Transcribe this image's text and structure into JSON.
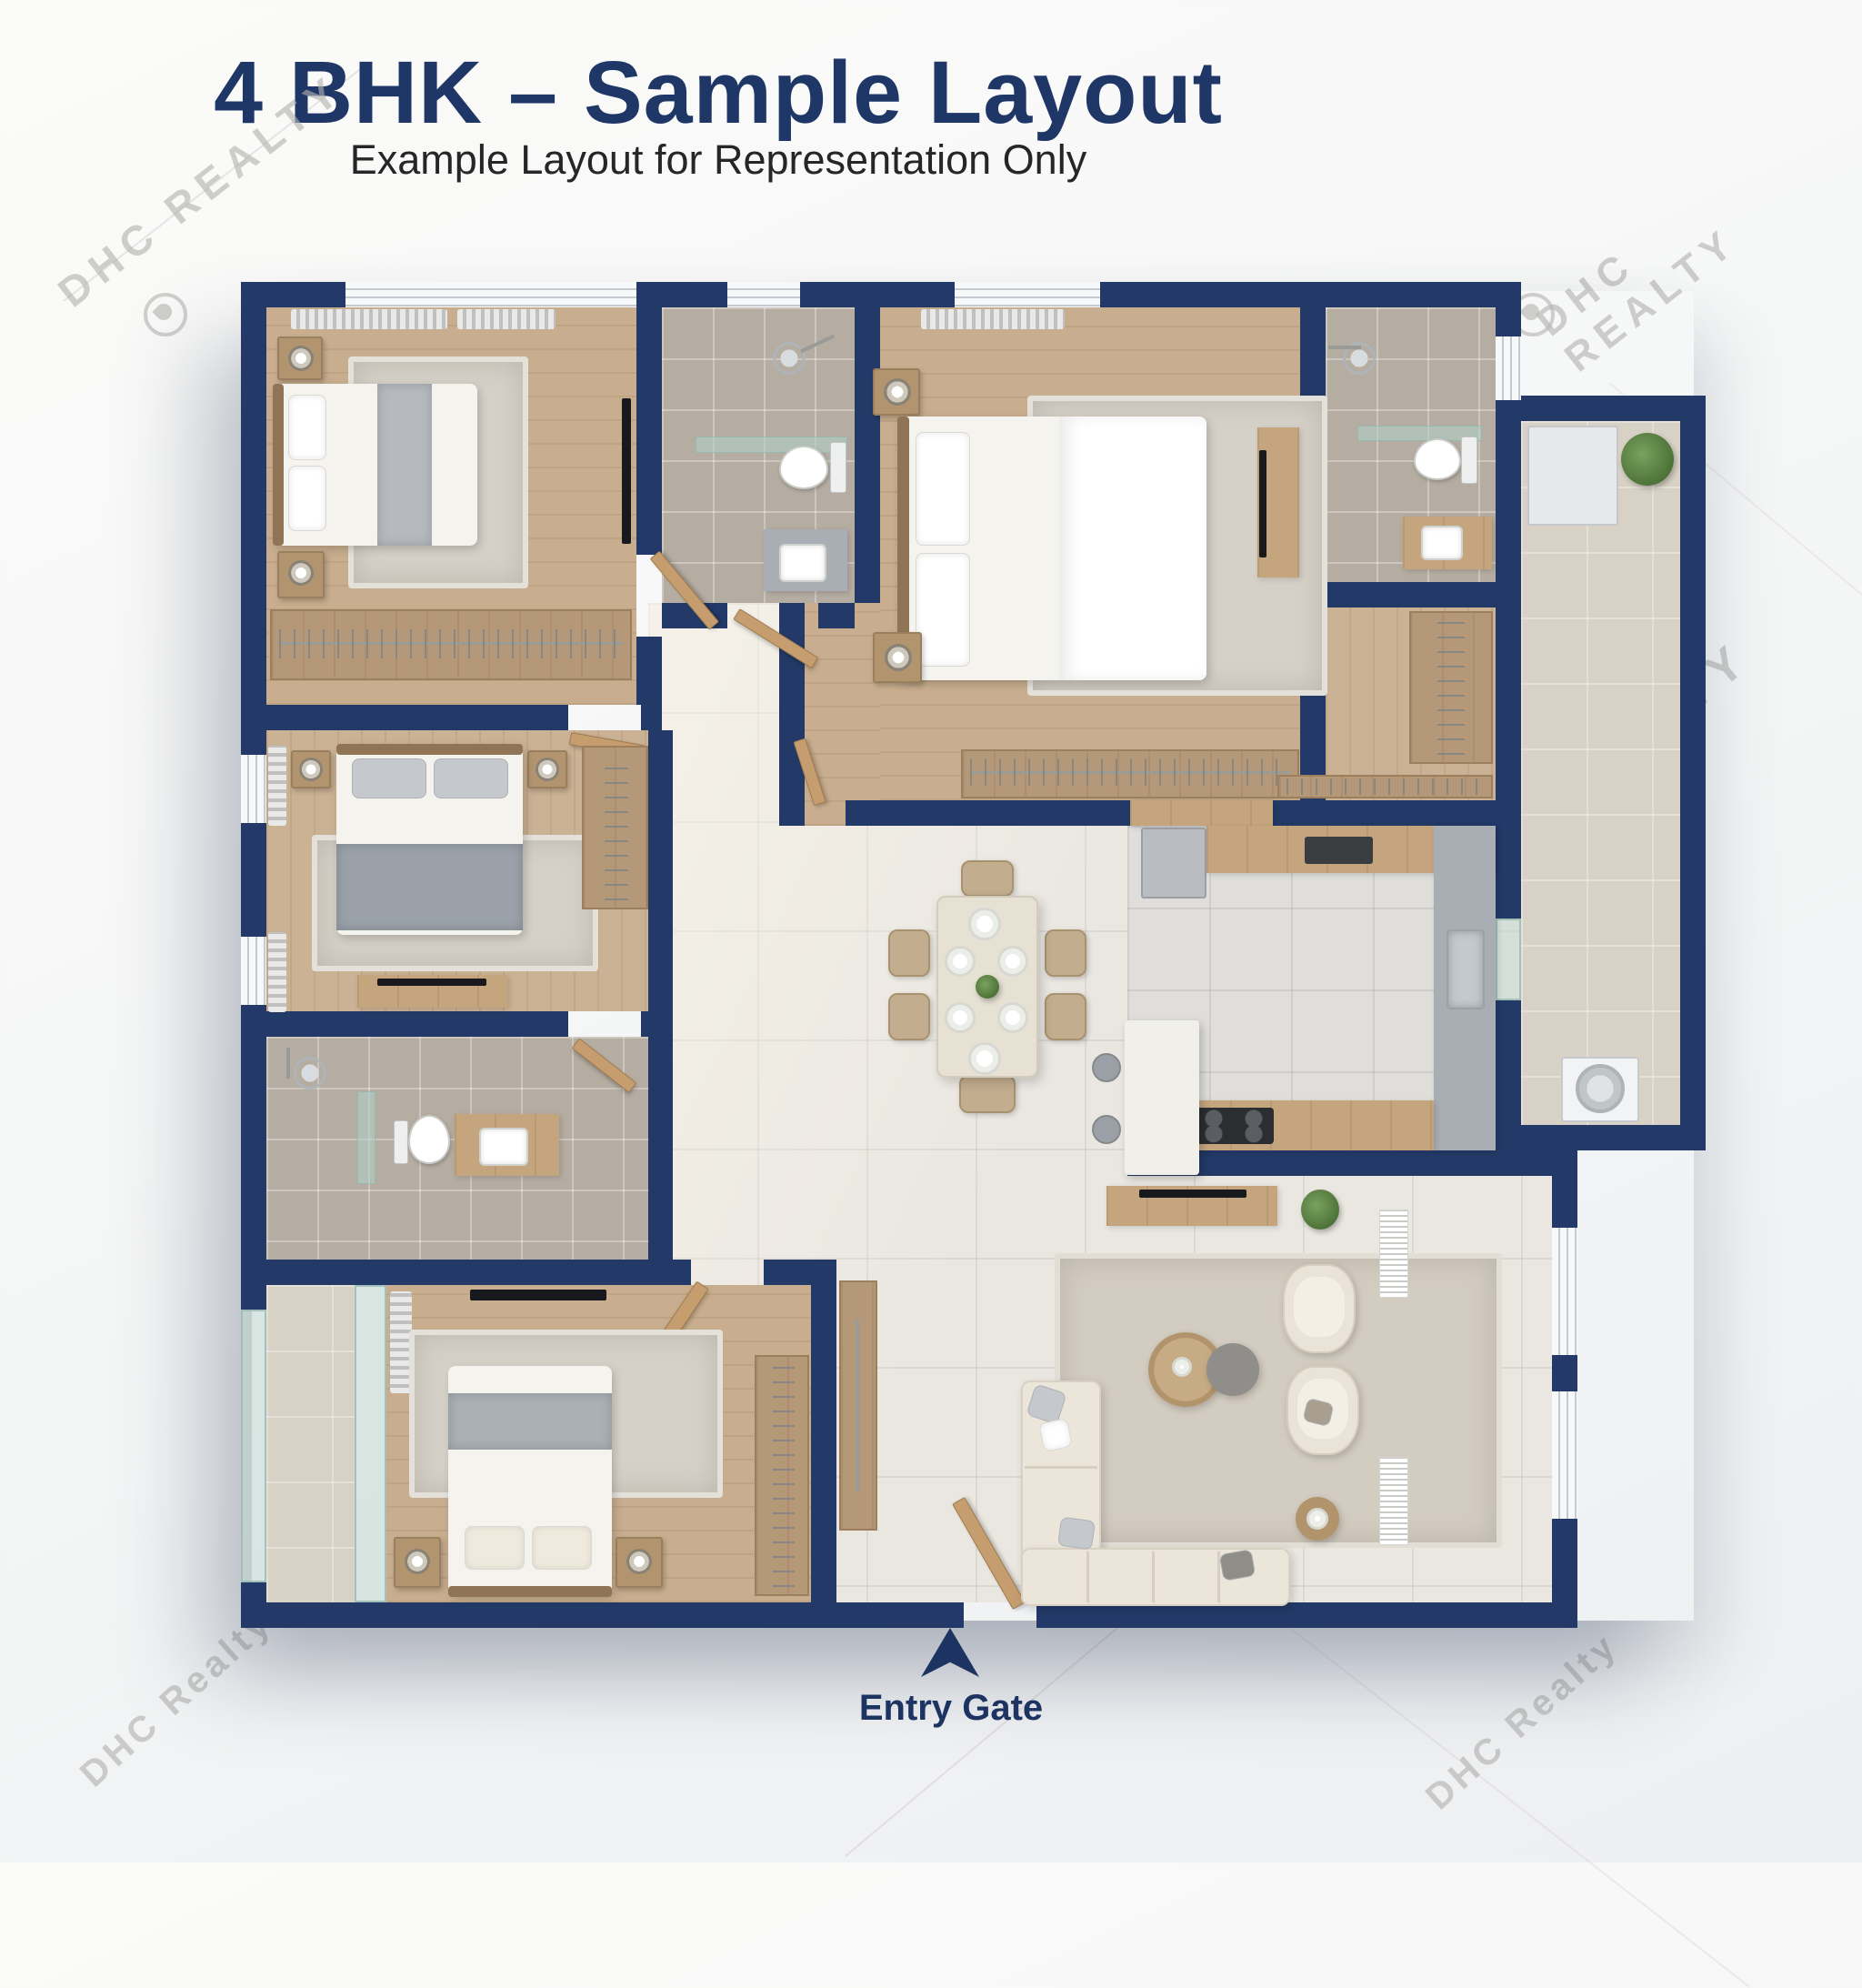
{
  "header": {
    "title": "4 BHK – Sample Layout",
    "subtitle": "Example Layout for Representation Only"
  },
  "entry": {
    "label": "Entry Gate"
  },
  "watermarks": {
    "w1": {
      "text": "DHC REALTY"
    },
    "w2": {
      "text": "DHC REALTY"
    },
    "w3": {
      "text": "DHC REALTY"
    },
    "w4": {
      "text": "DHC Realty"
    },
    "w5": {
      "text": "DHC Realty"
    }
  },
  "colors": {
    "wall_navy": "#233a68",
    "title_navy": "#1f3767",
    "subtitle_gray": "#262626",
    "wood_floor": "#c8ae8e",
    "bath_tile": "#b6ada2",
    "open_tile": "#eae7e1",
    "kitchen_tile": "#dfdedb",
    "utility_tile": "#d8d1c5",
    "accent_plant": "#5d7d44",
    "watermark_gray": "#b9b9b6"
  }
}
